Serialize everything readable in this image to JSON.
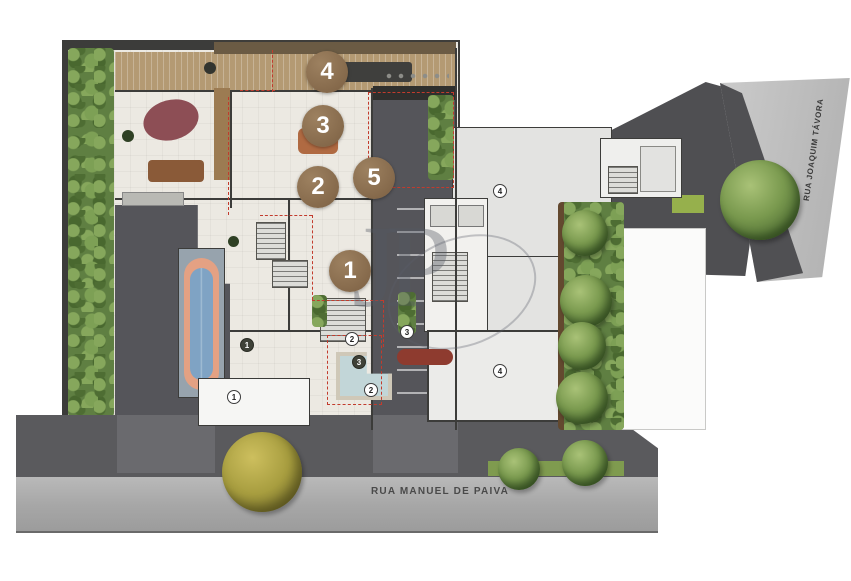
{
  "plan": {
    "unit_markers": [
      {
        "label": "1"
      },
      {
        "label": "2"
      },
      {
        "label": "3"
      },
      {
        "label": "4"
      },
      {
        "label": "5"
      }
    ],
    "point_markers": [
      {
        "label": "1",
        "variant": "dark"
      },
      {
        "label": "1",
        "variant": "light"
      },
      {
        "label": "2",
        "variant": "light"
      },
      {
        "label": "3",
        "variant": "dark"
      },
      {
        "label": "2",
        "variant": "light"
      },
      {
        "label": "3",
        "variant": "light"
      },
      {
        "label": "4",
        "variant": "light"
      },
      {
        "label": "4",
        "variant": "light"
      }
    ]
  },
  "streets": {
    "bottom": "RUA MANUEL DE PAIVA",
    "right": "RUA JOAQUIM TÁVORA"
  },
  "watermark": {
    "monogram": "JP"
  },
  "colors": {
    "unit_marker_brown": "#8E7356",
    "boundary_dashed_red": "#C23B2D",
    "asphalt_dark": "#55555A",
    "street_gray": "#ADADAD",
    "plan_floor_cream": "#ECE9E2",
    "roof_light_gray": "#E3E3E1",
    "garden_green": "#5F7F42",
    "pool_water_blue": "#7FA3C4",
    "pool_track_coral": "#E4A183",
    "deck_wood_tan": "#B49A73"
  }
}
